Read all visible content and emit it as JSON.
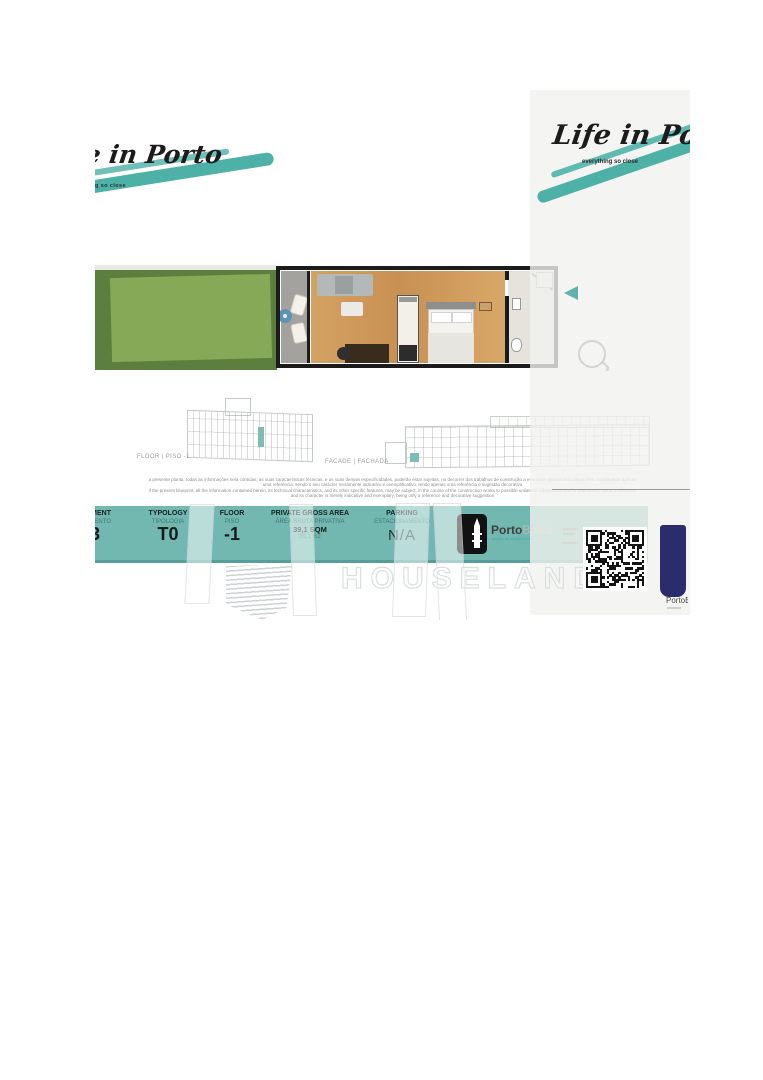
{
  "brand": {
    "name": "Life in Porto",
    "tagline": "everything so close",
    "teal": "#4db1a7"
  },
  "panel": {
    "nav_arrow_icon": "triangle-left",
    "zoom_icon": "magnifier"
  },
  "drawings": {
    "floor_label": "FLOOR | PISO -1",
    "facade_label": "FACADE | FACHADA",
    "highlight_color": "#7fbdb4"
  },
  "disclaimer": {
    "line1": "a presente planta, todas as informações nela contidas, as suas características técnicas, e as suas demais especificidades, poderão estar sujeitas, no decorrer dos trabalhos de construção a eventuais ajustes e/ou alterações, constituindo apenas",
    "line2": "uma referência, sendo o seu carácter meramente indicativo e exemplificativo, tendo apenas uma referência e sugestão decorativa",
    "line3": "if the present blueprint, all the information contained herein, its technical characteristics, and its other specific features, may be subject, in the course of the construction works to possible unilateral adjustments and/or alterations, being a reference",
    "line4": "and its character is merely indicative and exemplary, being only a reference and decorative suggestion"
  },
  "infobar": {
    "background": "#72b8b0",
    "apartment": {
      "label_en": "APARTMENT",
      "label_pt": "APARTAMENTO",
      "value": "3"
    },
    "typology": {
      "label_en": "TYPOLOGY",
      "label_pt": "TIPOLOGIA",
      "value": "T0"
    },
    "floor": {
      "label_en": "FLOOR",
      "label_pt": "PISO",
      "value": "-1"
    },
    "area": {
      "label_en": "PRIVATE GROSS AREA",
      "label_pt": "ÁREA BRUTA PRIVATIVA",
      "value": "39,1 SQM",
      "value_alt": "39,1 m2"
    },
    "parking": {
      "label_en": "PARKING",
      "label_pt": "ESTACIONAMENTO",
      "value": "N/A"
    }
  },
  "portobaixa": {
    "word_dark": "Porto",
    "word_light": "Baixa",
    "subtitle": "gestão de investimentos",
    "icon": "tower-icon"
  },
  "partner": {
    "name": "PortoBaixa",
    "color": "#2b2c6b"
  },
  "watermark": {
    "text": "HOUSELAND"
  }
}
